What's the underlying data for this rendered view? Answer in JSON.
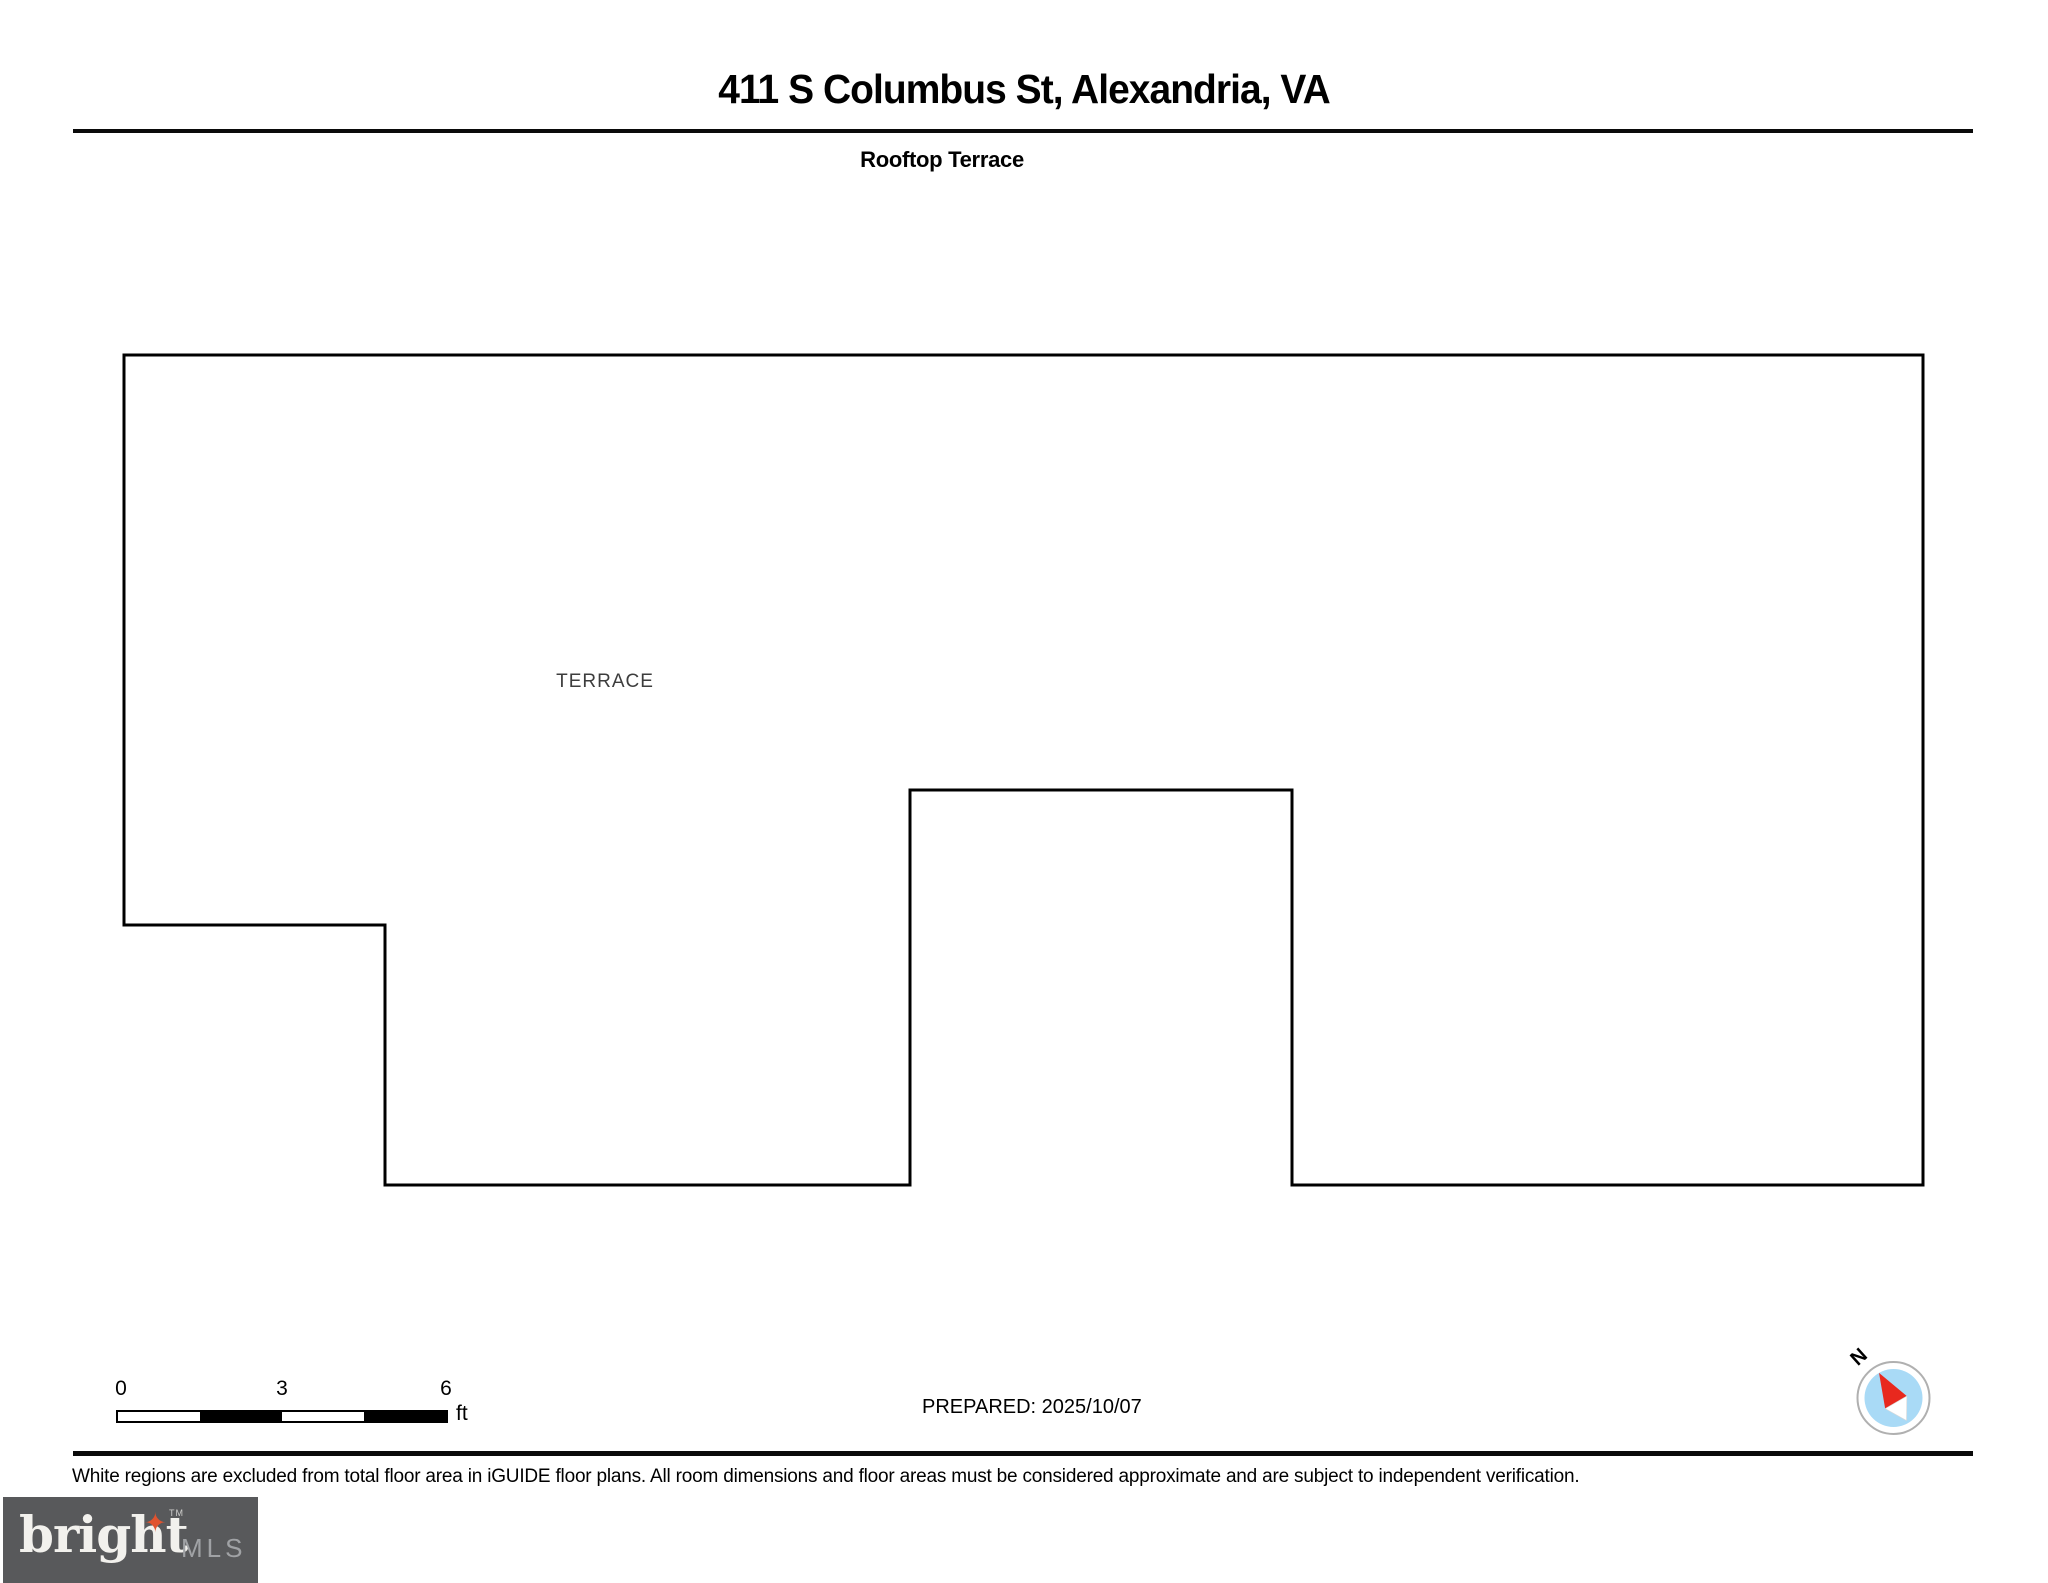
{
  "page": {
    "title": "411 S Columbus St, Alexandria, VA",
    "subtitle": "Rooftop Terrace"
  },
  "floor_plan": {
    "room_label": "TERRACE",
    "outline_points": "124,355 1923,355 1923,1185 1292,1185 1292,790 910,790 910,1185 385,1185 385,925 124,925",
    "line_color": "#000000"
  },
  "scale_bar": {
    "tick_labels": [
      "0",
      "3",
      "6"
    ],
    "unit": "ft"
  },
  "prepared": {
    "label": "PREPARED: 2025/10/07"
  },
  "compass": {
    "north_label": "N",
    "needle_north_color": "#e8281e",
    "needle_south_color": "#ffffff",
    "dial_color": "#a9daf6",
    "ring_color": "#b0b0b0"
  },
  "footer": {
    "disclaimer": "White regions are excluded from total floor area in iGUIDE floor plans. All room dimensions and floor areas must be considered approximate and are subject to independent verification."
  },
  "logo": {
    "brand": "bright",
    "tm": "TM",
    "suffix": "MLS",
    "bg_color": "#58595b",
    "star_glyph": "✦",
    "star_color": "#e0532f"
  }
}
